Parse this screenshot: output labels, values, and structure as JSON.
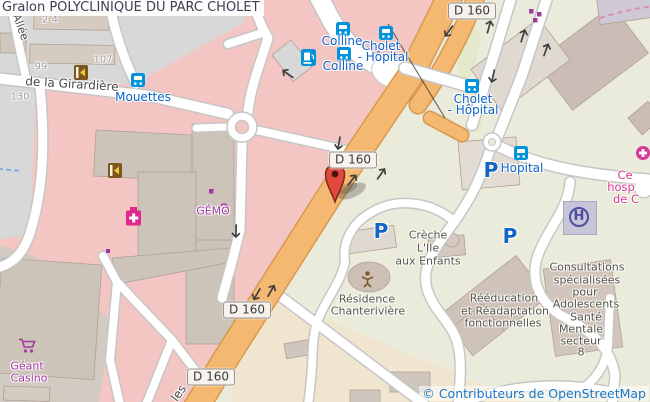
{
  "title": "Gralon POLYCLINIQUE DU PARC CHOLET",
  "attribution": "© Contributeurs de OpenStreetMap",
  "road_badge_label": "D 160",
  "bus_stops": [
    {
      "name": "Mouettes"
    },
    {
      "name": "Colline"
    },
    {
      "name": "Colline"
    },
    {
      "name": "Cholet",
      "name2": "- Hôpital"
    },
    {
      "name": "Cholet",
      "name2": "- Hôpital"
    },
    {
      "name": "Hopital"
    }
  ],
  "parking_symbol": "P",
  "helipad_symbol": "H",
  "pois": {
    "gemo": "GÉMO",
    "geant": [
      "Géant",
      "Casino"
    ],
    "creche": [
      "Crèche",
      "L'Ile",
      "aux Enfants"
    ],
    "residence": [
      "Résidence",
      "Chanterivière"
    ],
    "reeducation": [
      "Rééducation",
      "et Réadaptation",
      "fonctionnelles"
    ],
    "consultations": [
      "Consultations",
      "spécialisées",
      "pour",
      "Adolescents"
    ],
    "sante": [
      "Santé",
      "Mentale",
      "secteur",
      "8"
    ],
    "hospital_clipped": [
      "Ce",
      "hosp",
      "de C"
    ]
  },
  "streets": {
    "girardiere": "de la Girardière",
    "allee": "Allée",
    "les_fragment": "les"
  },
  "house_numbers": [
    "2 4",
    "107",
    "99",
    "130"
  ],
  "colors": {
    "residential_pink": "#F3C6C3",
    "campus_green": "#EBEBDB",
    "beige": "#F0E6CF",
    "retail_grey": "#D7D7D7",
    "road_orange": "#F5B871",
    "orange_casing": "#D79850",
    "transport_blue": "#0092DA",
    "bus_label_blue": "#0D62C8",
    "parking_blue": "#1365C4",
    "shop_purple": "#A43BA4",
    "health_magenta": "#D63A96",
    "marker_red": "#E2473C"
  }
}
